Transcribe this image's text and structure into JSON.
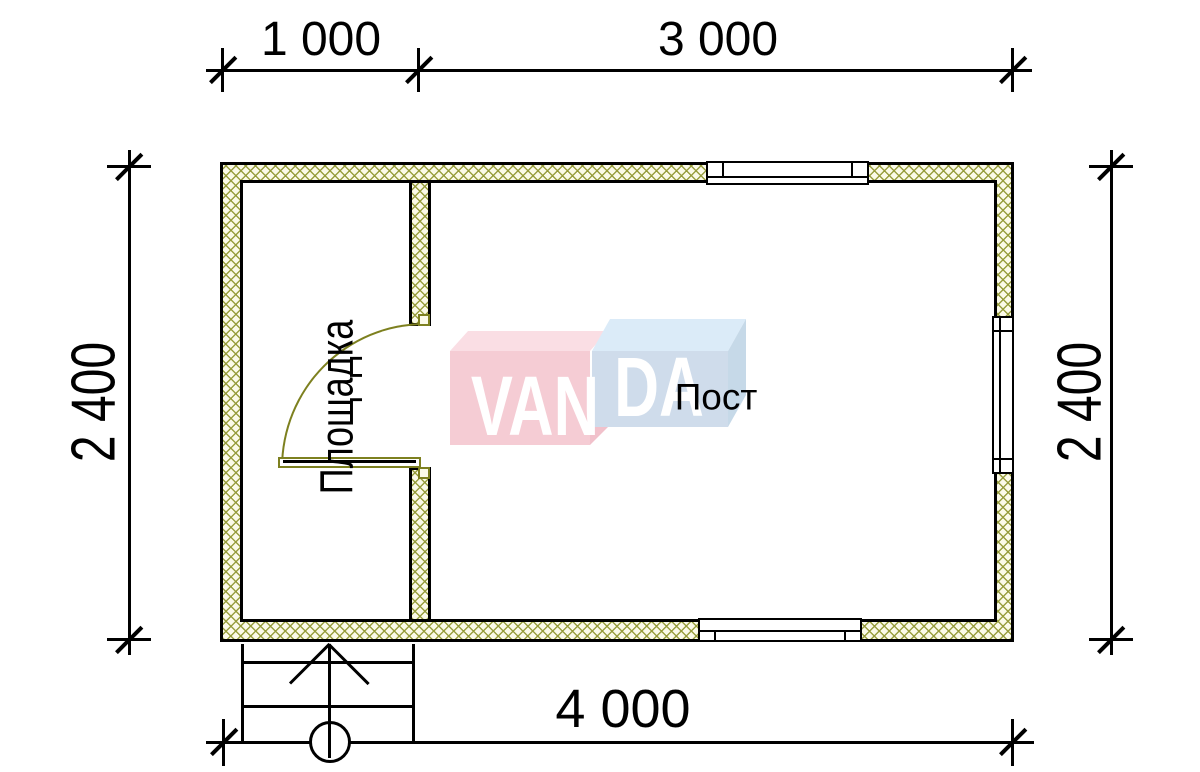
{
  "dimensions": {
    "top": [
      {
        "label": "1 000"
      },
      {
        "label": "3 000"
      }
    ],
    "left": {
      "label": "2 400"
    },
    "right": {
      "label": "2 400"
    },
    "bottom": {
      "label": "4 000"
    }
  },
  "rooms": {
    "vestibule": "Площадка",
    "main": "Пост"
  },
  "logo": {
    "brand": "VANDA",
    "left_text": "VAN",
    "right_text": "DA",
    "pink_front": "#f5c8d1",
    "pink_top": "#fadce2",
    "blue_front": "#ccdaea",
    "blue_top": "#d8eaf8",
    "blue_side": "#c2d6e7"
  },
  "colors": {
    "wall_hatch_line": "#949a38",
    "wall_hatch_bg": "#fbfae8",
    "door": "#7d801f",
    "line": "#000000",
    "background": "#ffffff"
  }
}
